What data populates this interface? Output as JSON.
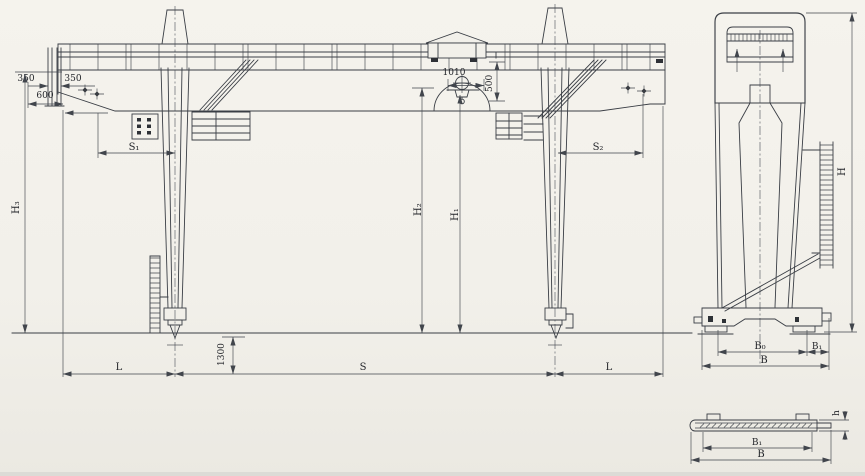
{
  "colors": {
    "background": "#f2f0ea",
    "line": "#3a3e45",
    "text": "#23252a"
  },
  "elevation": {
    "dim_350_left": "350",
    "dim_350_right": "350",
    "dim_600": "600",
    "dim_1010": "1010",
    "dim_500": "500",
    "dim_1300": "1300",
    "dim_s1": "S₁",
    "dim_s2": "S₂",
    "dim_h1": "H₁",
    "dim_h2": "H₂",
    "dim_h3": "H₃",
    "dim_span": "S",
    "dim_l_left": "L",
    "dim_l_right": "L"
  },
  "end_view": {
    "dim_h": "H",
    "dim_b0": "B₀",
    "dim_b1": "B₁",
    "dim_b": "B"
  },
  "section_view": {
    "dim_b1": "B₁",
    "dim_b": "B",
    "dim_h": "h"
  }
}
